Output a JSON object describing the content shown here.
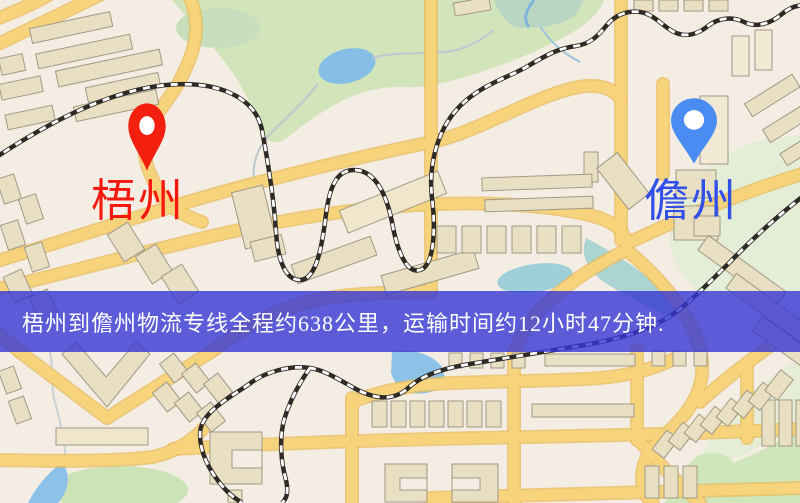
{
  "banner": {
    "text": "梧州到儋州物流专线全程约638公里，运输时间约12小时47分钟.",
    "background_color": "#3737d4",
    "background_opacity": "0.8",
    "text_color": "#ffffff"
  },
  "markers": {
    "origin": {
      "name": "梧州",
      "pin_color": "#f3200f",
      "label_color": "#f5180f"
    },
    "destination": {
      "name": "儋州",
      "pin_color": "#4a8cf2",
      "label_color": "#3050e8"
    }
  },
  "route": {
    "origin": "梧州",
    "destination": "儋州",
    "distance": "约638公里",
    "duration": "约12小时47分钟"
  },
  "map_colors": {
    "background": "#f4ede3",
    "road_yellow": "#f7d47c",
    "park_green": "#d2e4ba",
    "water_blue": "#8cc2e8",
    "building_tan": "#e9dfc2",
    "railway_black": "#2e2a26"
  }
}
